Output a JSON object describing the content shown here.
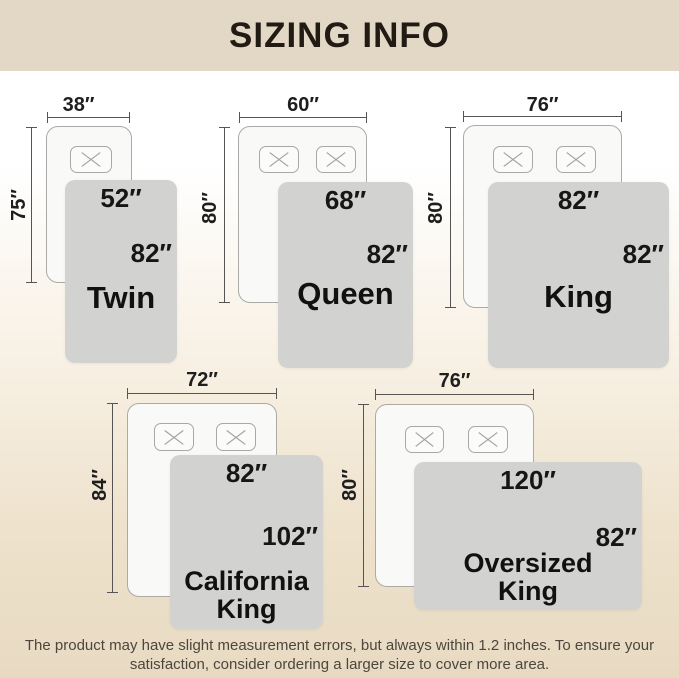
{
  "header": {
    "title": "SIZING INFO"
  },
  "diagrams": [
    {
      "name": "Twin",
      "bed_width": "38″",
      "bed_height": "75″",
      "blanket_width": "52″",
      "blanket_height": "82″",
      "pillow_count": 1
    },
    {
      "name": "Queen",
      "bed_width": "60″",
      "bed_height": "80″",
      "blanket_width": "68″",
      "blanket_height": "82″",
      "pillow_count": 2
    },
    {
      "name": "King",
      "bed_width": "76″",
      "bed_height": "80″",
      "blanket_width": "82″",
      "blanket_height": "82″",
      "pillow_count": 2
    },
    {
      "name": "California King",
      "bed_width": "72″",
      "bed_height": "84″",
      "blanket_width": "82″",
      "blanket_height": "102″",
      "pillow_count": 2
    },
    {
      "name": "Oversized King",
      "bed_width": "76″",
      "bed_height": "80″",
      "blanket_width": "120″",
      "blanket_height": "82″",
      "pillow_count": 2
    }
  ],
  "footer": {
    "text": "The product may have slight measurement errors, but always within 1.2 inches. To ensure your satisfaction, consider ordering a larger size to cover more area."
  },
  "colors": {
    "header_background": "#e3d7c5",
    "title_text": "#211b14",
    "page_bottom": "#e8dac2",
    "blanket_fill": "#d2d2d0",
    "bed_fill": "#f9f9f8",
    "bed_border": "#abaaa6",
    "dimension_line": "#555555",
    "label_text": "#1c1c1c",
    "footer_text": "#4c463c"
  }
}
